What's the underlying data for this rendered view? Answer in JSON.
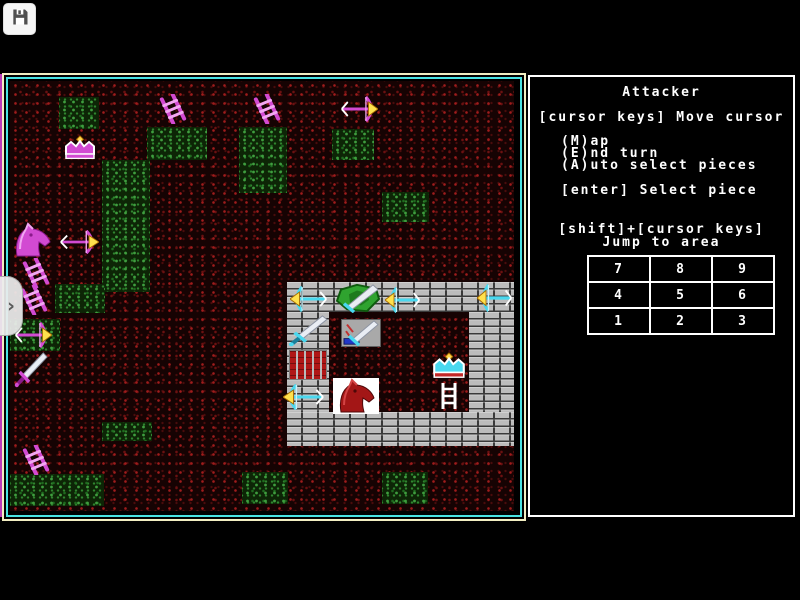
{
  "toolbar": {
    "save_icon": "floppy-disk-icon"
  },
  "side_tab": {
    "chevron": "›"
  },
  "panel": {
    "title": "Attacker",
    "line_move": "[cursor keys] Move cursor",
    "menu": [
      "(M)ap",
      "(E)nd turn",
      "(A)uto select pieces"
    ],
    "line_select": "[enter] Select piece",
    "jump_title1": "[shift]+[cursor keys]",
    "jump_title2": "Jump to area",
    "grid": [
      [
        "7",
        "8",
        "9"
      ],
      [
        "4",
        "5",
        "6"
      ],
      [
        "1",
        "2",
        "3"
      ]
    ]
  },
  "map": {
    "colors": {
      "attacker": "#d24ad2",
      "defender": "#49d8ef",
      "terrain": "#160303",
      "terrain_speck": "#a01c1c",
      "grass": "#2f852f",
      "wall": "#bcbcbc",
      "gate": "#b01616",
      "border_outer": "#f2eec2",
      "border_inner": "#49e3e3"
    },
    "grass_patches": [
      {
        "x": 49,
        "y": 16,
        "w": 40,
        "h": 32
      },
      {
        "x": 137,
        "y": 46,
        "w": 60,
        "h": 33
      },
      {
        "x": 92,
        "y": 79,
        "w": 48,
        "h": 132
      },
      {
        "x": 229,
        "y": 46,
        "w": 48,
        "h": 66
      },
      {
        "x": 322,
        "y": 48,
        "w": 42,
        "h": 31
      },
      {
        "x": 372,
        "y": 111,
        "w": 47,
        "h": 30
      },
      {
        "x": 45,
        "y": 203,
        "w": 50,
        "h": 29
      },
      {
        "x": 0,
        "y": 238,
        "w": 50,
        "h": 32
      },
      {
        "x": 92,
        "y": 341,
        "w": 50,
        "h": 19
      },
      {
        "x": 0,
        "y": 393,
        "w": 94,
        "h": 32
      },
      {
        "x": 232,
        "y": 391,
        "w": 46,
        "h": 32
      },
      {
        "x": 372,
        "y": 391,
        "w": 46,
        "h": 32
      }
    ],
    "walls": [
      {
        "x": 277,
        "y": 201,
        "w": 227,
        "h": 30,
        "part": "top"
      },
      {
        "x": 277,
        "y": 231,
        "w": 42,
        "h": 100,
        "part": "left"
      },
      {
        "x": 459,
        "y": 231,
        "w": 45,
        "h": 100,
        "part": "right"
      },
      {
        "x": 277,
        "y": 331,
        "w": 227,
        "h": 34,
        "part": "bottom"
      }
    ],
    "gate": {
      "x": 279,
      "y": 269,
      "w": 36,
      "h": 28
    },
    "pieces": [
      {
        "type": "crown",
        "side": "attacker",
        "x": 52,
        "y": 54,
        "w": 36,
        "h": 26
      },
      {
        "type": "ladder",
        "side": "attacker",
        "x": 147,
        "y": 13,
        "w": 32,
        "h": 30
      },
      {
        "type": "ladder",
        "side": "attacker",
        "x": 241,
        "y": 13,
        "w": 32,
        "h": 30
      },
      {
        "type": "bowR",
        "side": "attacker",
        "x": 330,
        "y": 15,
        "w": 38,
        "h": 26
      },
      {
        "type": "horse",
        "side": "attacker",
        "x": 2,
        "y": 141,
        "w": 40,
        "h": 36
      },
      {
        "type": "bowR",
        "side": "attacker",
        "x": 49,
        "y": 149,
        "w": 40,
        "h": 24
      },
      {
        "type": "ladder",
        "side": "attacker",
        "x": 10,
        "y": 177,
        "w": 32,
        "h": 30
      },
      {
        "type": "ladder",
        "side": "attacker",
        "x": 8,
        "y": 204,
        "w": 32,
        "h": 30
      },
      {
        "type": "bowR",
        "side": "attacker",
        "x": 4,
        "y": 241,
        "w": 38,
        "h": 26
      },
      {
        "type": "sword",
        "side": "attacker",
        "x": 4,
        "y": 271,
        "w": 34,
        "h": 36
      },
      {
        "type": "ladder",
        "side": "attacker",
        "x": 10,
        "y": 364,
        "w": 32,
        "h": 30
      },
      {
        "type": "bowL",
        "side": "defender",
        "x": 280,
        "y": 205,
        "w": 38,
        "h": 26
      },
      {
        "type": "shield",
        "side": "defender",
        "x": 325,
        "y": 202,
        "w": 46,
        "h": 30
      },
      {
        "type": "bowL",
        "side": "defender",
        "x": 375,
        "y": 206,
        "w": 36,
        "h": 26
      },
      {
        "type": "bowL",
        "side": "defender",
        "x": 467,
        "y": 203,
        "w": 36,
        "h": 28
      },
      {
        "type": "sword",
        "side": "defender",
        "x": 278,
        "y": 234,
        "w": 40,
        "h": 32
      },
      {
        "type": "swordTile",
        "side": "defender",
        "x": 331,
        "y": 238,
        "w": 40,
        "h": 28
      },
      {
        "type": "crown",
        "side": "defender",
        "x": 420,
        "y": 271,
        "w": 38,
        "h": 28
      },
      {
        "type": "ladderW",
        "side": "white",
        "x": 429,
        "y": 301,
        "w": 20,
        "h": 28
      },
      {
        "type": "bowL",
        "side": "defender",
        "x": 273,
        "y": 303,
        "w": 42,
        "h": 26
      },
      {
        "type": "horseTile",
        "side": "red",
        "x": 323,
        "y": 297,
        "w": 46,
        "h": 36
      }
    ]
  }
}
